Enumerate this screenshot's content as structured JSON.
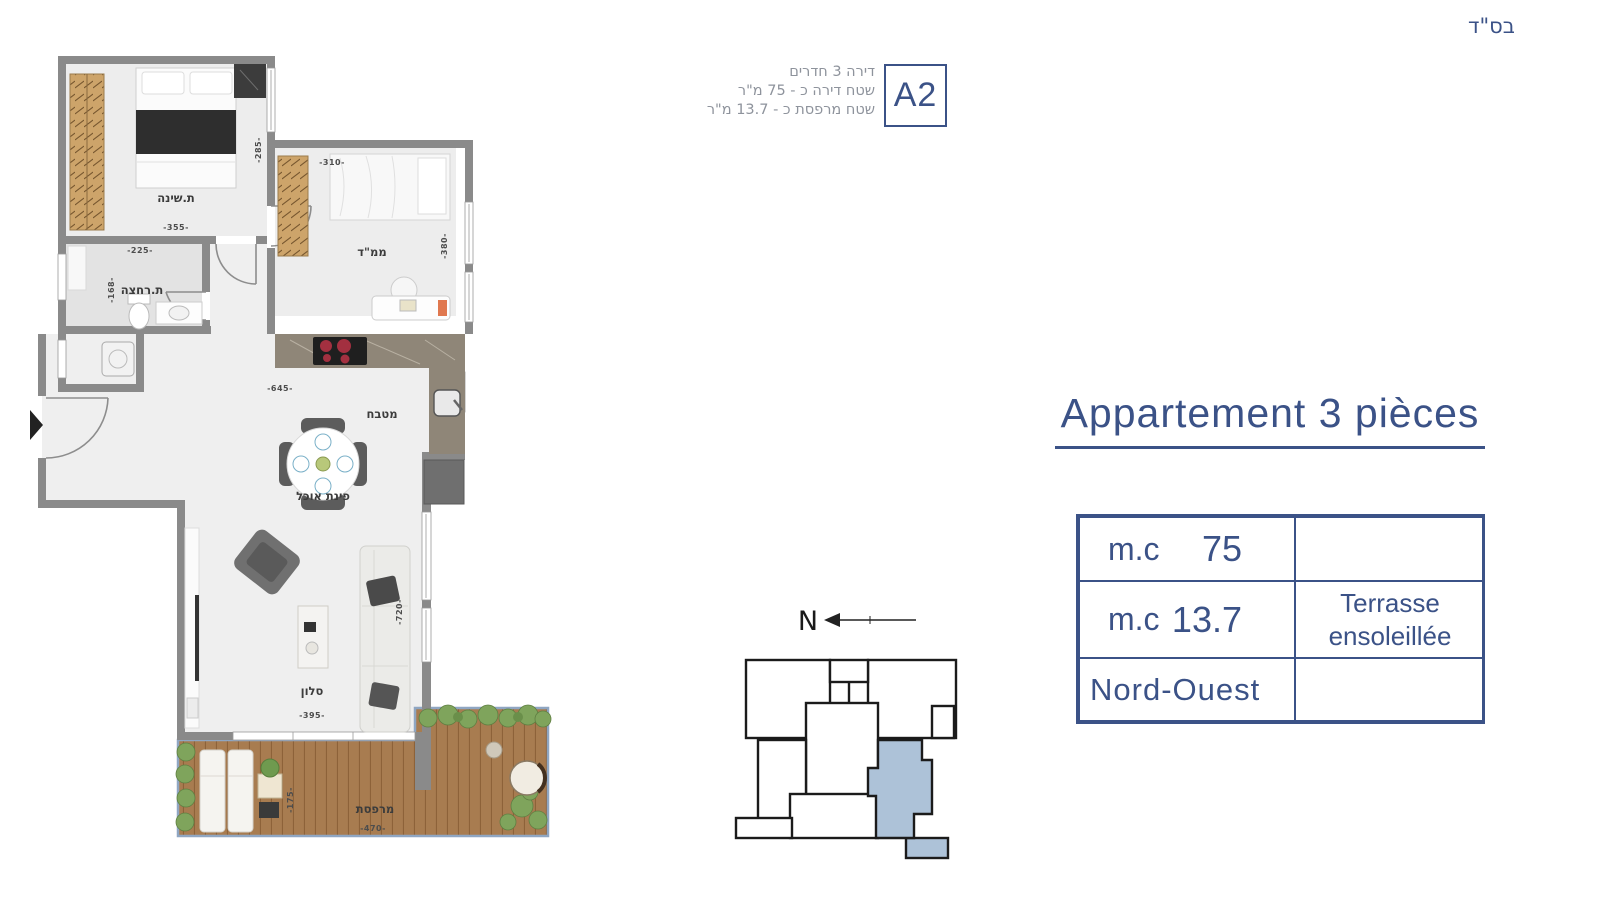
{
  "page": {
    "bsd": "בס\"ד"
  },
  "header": {
    "line1": "דירה 3 חדרים",
    "line2": "שטח דירה כ - 75 מ\"ר",
    "line3": "שטח מרפסת כ - 13.7 מ\"ר",
    "unit_label": "A2"
  },
  "floorplan": {
    "bedroom": {
      "label": "ת.שינה",
      "width": "-355-",
      "height": "-285-"
    },
    "mamad": {
      "label": "ממ\"ד",
      "width": "-310-",
      "height": "-380-"
    },
    "bathroom": {
      "label": "ת.רחצה",
      "width": "-225-",
      "height": "-168-"
    },
    "kitchen": {
      "label": "מטבח",
      "width": "-645-"
    },
    "dining": {
      "label": "פינת אוכל"
    },
    "living": {
      "label": "סלון",
      "width": "-395-",
      "height": "-720-"
    },
    "terrace": {
      "label": "מרפסת",
      "width": "-470-",
      "height": "-175-"
    }
  },
  "compass": {
    "north": "N"
  },
  "details": {
    "title": "Appartement 3 pièces",
    "table": {
      "row1_label": "m.c",
      "row1_value": "75",
      "row2_label": "m.c",
      "row2_value": "13.7",
      "row2_note_line1": "Terrasse",
      "row2_note_line2": "ensoleillée",
      "row3_label": "Nord-Ouest"
    }
  },
  "colors": {
    "accent": "#3b5287",
    "unit_highlight": "#adc2d8",
    "wall": "#8a8a8a"
  }
}
